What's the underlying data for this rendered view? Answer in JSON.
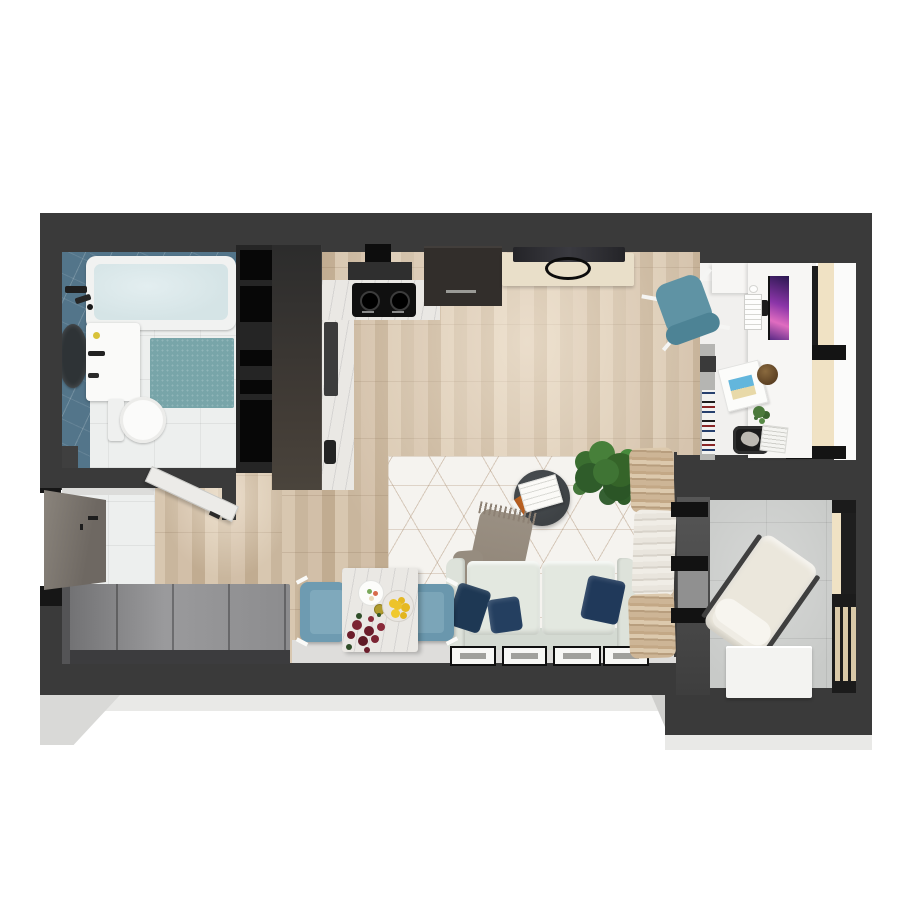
{
  "scene": {
    "type": "apartment-floor-plan-3d-render",
    "view": "top-down",
    "background": "#ffffff",
    "counts": {
      "picture_frames": 4,
      "sofa_pillows": 3,
      "dining_chairs": 2,
      "cooktop_burners": 2,
      "shelf_boxes": 5
    }
  },
  "palette": {
    "wall": "#3a3a3a",
    "wallDark": "#161616",
    "wood": "#ccb9a2",
    "blueTile": "#53758a",
    "water": "#d5e4e6",
    "mat": "#78a5a9",
    "marble": "#eae8e4",
    "darkCab": "#322e2b",
    "consoleBeige": "#e9dfc9",
    "rugBase": "#f5f3ef",
    "sofa": "#e3e8e0",
    "navy": "#20395a",
    "throw": "#8d8174",
    "coffee": "#3e4245",
    "plant": "#3f7434",
    "chairBlue": "#6e9bb1",
    "chairTeal": "#5f93a4",
    "lemon": "#edc32a",
    "tulip": "#7c2433",
    "deskWhite": "#f7f6f4",
    "monitorA": "#8b35a8",
    "monitorB": "#e06cc0",
    "paneBeige": "#f0e2c4",
    "balconyFloor": "#c8cac8",
    "lounge": "#ebe7dc",
    "clothesBeige": "#c6ad8d",
    "clothesWhite": "#eeebe4",
    "sideboardTop": "#95959a",
    "doorGray": "#6e6862",
    "shadow": "#e9e9e7"
  },
  "rooms": [
    {
      "id": "bathroom",
      "label": "bathroom",
      "features": [
        "bathtub",
        "shower-fixture",
        "mirror",
        "vanity-sink",
        "toilet",
        "bath-mat",
        "blue-tile-wall",
        "corner-cabinet"
      ]
    },
    {
      "id": "hallway",
      "label": "entry-hallway",
      "features": [
        "entry-door",
        "bathroom-door",
        "sideboard",
        "tile-floor"
      ]
    },
    {
      "id": "kitchen",
      "label": "kitchen",
      "features": [
        "tall-cabinet",
        "range-hood",
        "cooktop",
        "marble-counter",
        "sink",
        "dark-cabinet",
        "shelf-column"
      ]
    },
    {
      "id": "living-dining",
      "label": "living-dining-area",
      "features": [
        "sofa",
        "pillows",
        "throw-blanket",
        "coffee-table",
        "magazines",
        "area-rug",
        "potted-plant",
        "tv-console",
        "ceiling-lamp",
        "dining-table",
        "flowers",
        "lemon-bowl",
        "dining-chairs",
        "clothes-rack",
        "picture-frames"
      ]
    },
    {
      "id": "workspace",
      "label": "desk-nook",
      "features": [
        "desk",
        "monitor",
        "keyboard",
        "mouse",
        "office-chair",
        "book-spines-shelf",
        "magazine-file",
        "plant-pot",
        "storage-basket",
        "window"
      ]
    },
    {
      "id": "balcony",
      "label": "balcony",
      "features": [
        "lounge-chair",
        "side-table-box",
        "glazing",
        "slat-railing",
        "concrete-floor"
      ]
    }
  ]
}
